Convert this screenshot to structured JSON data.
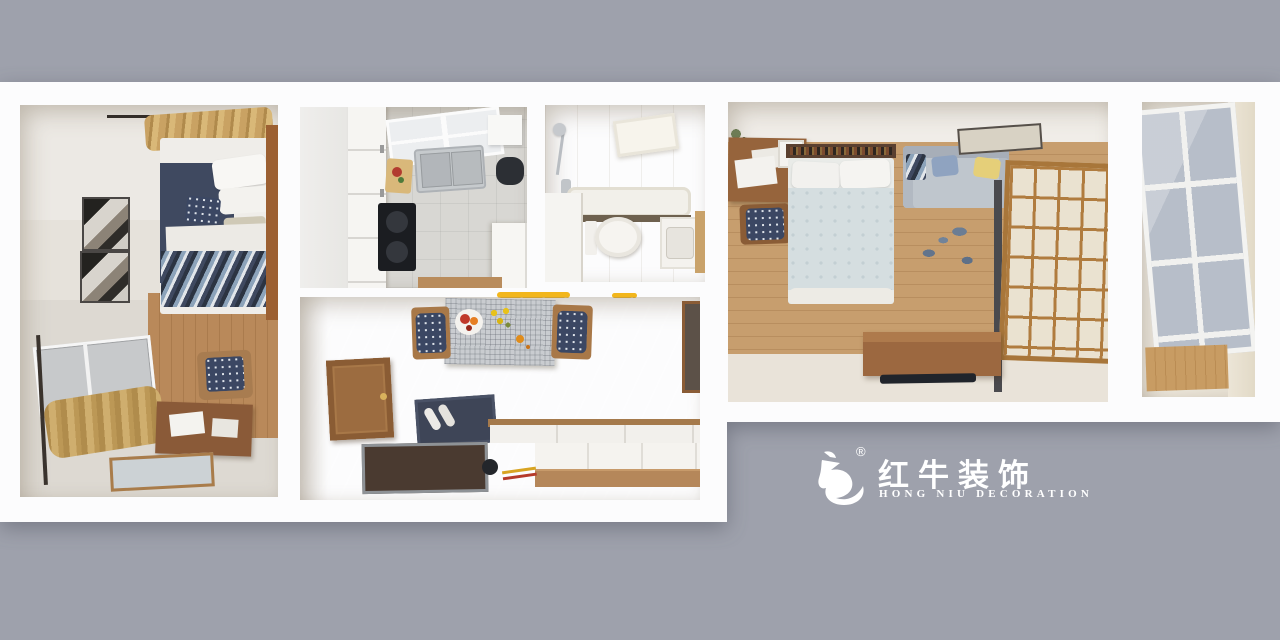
{
  "scene": {
    "background_color": "#9ea1ac",
    "slab_color": "#fcfcfd"
  },
  "watermark": {
    "registered_mark": "®",
    "brand_cn": "红牛装饰",
    "brand_en": "HONG NIU DECORATION",
    "text_color": "#ffffff"
  },
  "rooms": [
    {
      "id": "bedroom-1"
    },
    {
      "id": "kitchen"
    },
    {
      "id": "bathroom"
    },
    {
      "id": "living-dining"
    },
    {
      "id": "master-bedroom"
    },
    {
      "id": "balcony"
    }
  ]
}
